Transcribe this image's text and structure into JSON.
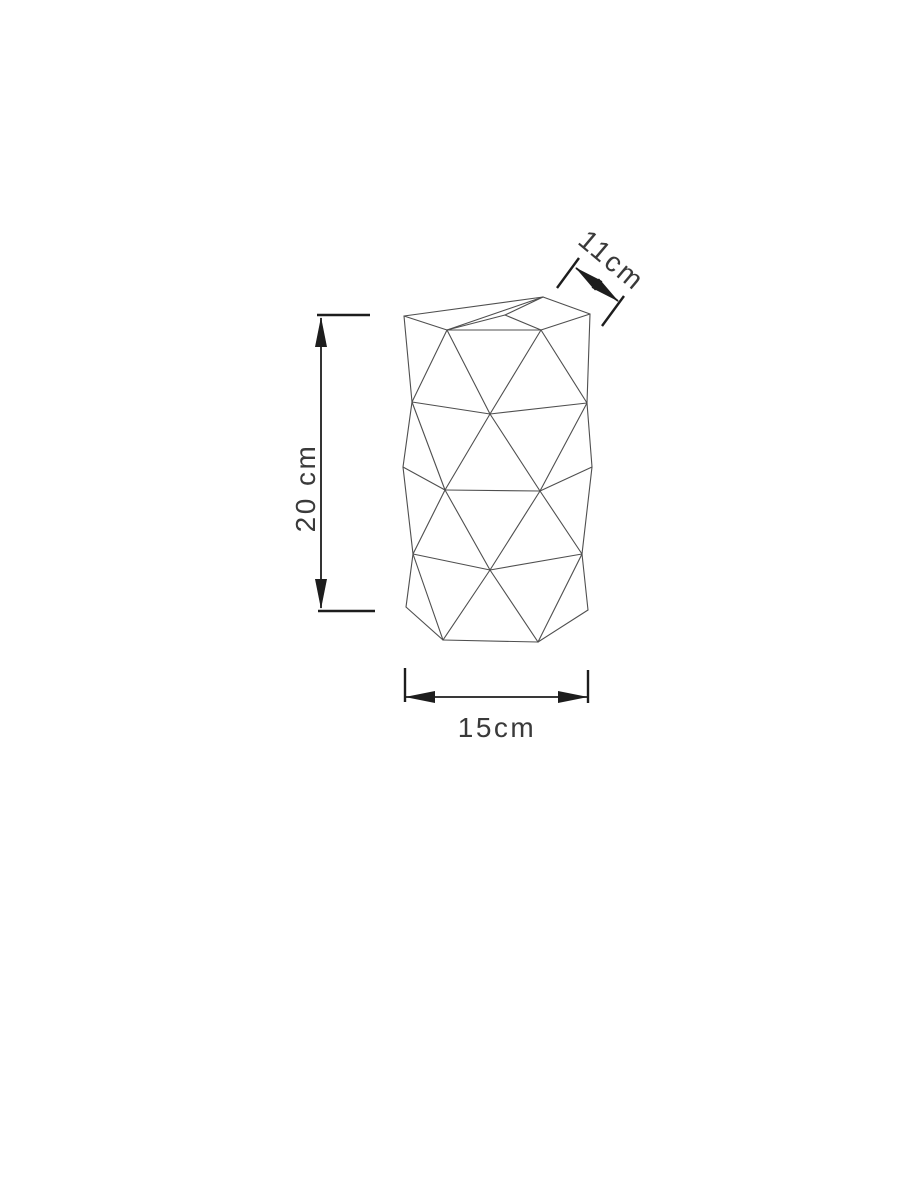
{
  "page": {
    "background": "#ffffff",
    "description": "Technical dimension drawing of a faceted triangulated cylinder (geometric lamp shade / vase)"
  },
  "drawing": {
    "colors": {
      "facet_line": "#4f4f4f",
      "dimension_line": "#1d1d1d",
      "label_text": "#3a3a3a"
    },
    "vertices": {
      "L0": [
        404,
        316
      ],
      "A1": [
        447,
        330
      ],
      "TP": [
        505,
        315
      ],
      "A3": [
        541,
        330
      ],
      "BP": [
        543,
        297
      ],
      "R0": [
        590,
        314
      ],
      "BL": [
        412,
        402
      ],
      "BC": [
        490,
        414
      ],
      "BR": [
        587,
        403
      ],
      "CL": [
        403,
        467
      ],
      "C1": [
        445,
        490
      ],
      "C2": [
        540,
        491
      ],
      "CR": [
        592,
        467
      ],
      "DL": [
        413,
        554
      ],
      "DC": [
        490,
        570
      ],
      "DR": [
        582,
        554
      ],
      "EL": [
        406,
        607
      ],
      "E1": [
        443,
        640
      ],
      "E2": [
        538,
        642
      ],
      "ER": [
        588,
        610
      ]
    },
    "segments": [
      [
        "L0",
        "BP"
      ],
      [
        "BP",
        "R0"
      ],
      [
        "L0",
        "A1"
      ],
      [
        "A1",
        "TP"
      ],
      [
        "TP",
        "A3"
      ],
      [
        "A3",
        "R0"
      ],
      [
        "A1",
        "A3"
      ],
      [
        "TP",
        "BP"
      ],
      [
        "A1",
        "BP"
      ],
      [
        "L0",
        "BL"
      ],
      [
        "A1",
        "BL"
      ],
      [
        "A1",
        "BC"
      ],
      [
        "A3",
        "BC"
      ],
      [
        "A3",
        "BR"
      ],
      [
        "R0",
        "BR"
      ],
      [
        "BL",
        "BC"
      ],
      [
        "BC",
        "BR"
      ],
      [
        "BL",
        "CL"
      ],
      [
        "BL",
        "C1"
      ],
      [
        "BC",
        "C1"
      ],
      [
        "BC",
        "C2"
      ],
      [
        "BR",
        "C2"
      ],
      [
        "BR",
        "CR"
      ],
      [
        "CL",
        "C1"
      ],
      [
        "C1",
        "C2"
      ],
      [
        "C2",
        "CR"
      ],
      [
        "CL",
        "DL"
      ],
      [
        "C1",
        "DL"
      ],
      [
        "C1",
        "DC"
      ],
      [
        "C2",
        "DC"
      ],
      [
        "C2",
        "DR"
      ],
      [
        "CR",
        "DR"
      ],
      [
        "DL",
        "DC"
      ],
      [
        "DC",
        "DR"
      ],
      [
        "DL",
        "EL"
      ],
      [
        "DL",
        "E1"
      ],
      [
        "DC",
        "E1"
      ],
      [
        "DC",
        "E2"
      ],
      [
        "DR",
        "E2"
      ],
      [
        "DR",
        "ER"
      ],
      [
        "EL",
        "E1"
      ],
      [
        "E1",
        "E2"
      ],
      [
        "E2",
        "ER"
      ]
    ],
    "dimensions": [
      {
        "id": "height",
        "label": "20 cm",
        "value_cm": 20,
        "orientation": "vertical",
        "line": [
          321,
          318,
          321,
          608
        ],
        "extensions": [
          [
            317,
            315,
            370,
            315
          ],
          [
            318,
            611,
            375,
            611
          ]
        ],
        "label_pos": [
          305,
          488
        ],
        "label_rotation": -90
      },
      {
        "id": "width",
        "label": "15cm",
        "value_cm": 15,
        "orientation": "horizontal",
        "line": [
          406,
          697,
          587,
          697
        ],
        "extensions": [
          [
            405,
            668,
            405,
            702
          ],
          [
            588,
            670,
            588,
            703
          ]
        ],
        "label_pos": [
          497,
          727
        ],
        "label_rotation": 0
      },
      {
        "id": "depth",
        "label": "11cm",
        "value_cm": 11,
        "orientation": "diagonal",
        "line": [
          576,
          268,
          618,
          301
        ],
        "extensions": [
          [
            557,
            288,
            579,
            258
          ],
          [
            602,
            326,
            624,
            296
          ]
        ],
        "label_pos": [
          612,
          260
        ],
        "label_rotation": 40
      }
    ]
  }
}
